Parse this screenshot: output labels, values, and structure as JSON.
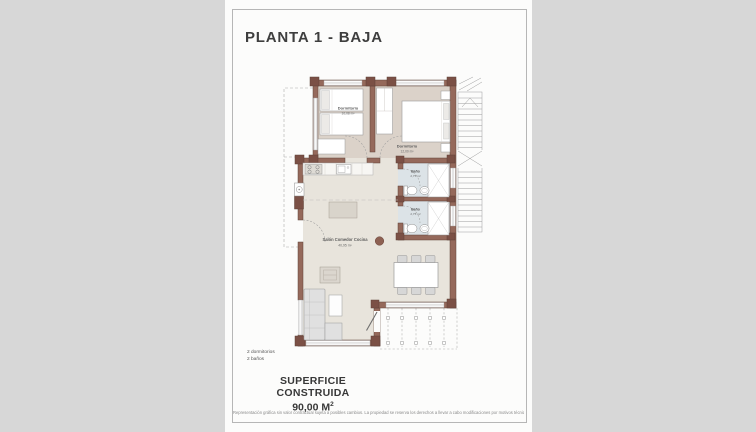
{
  "page": {
    "title": "PLANTA 1 - BAJA",
    "summary": {
      "line1": "2 dormitorios",
      "line2": "2 baños"
    },
    "superficie": {
      "label": "SUPERFICIE CONSTRUIDA",
      "value": "90,00 M",
      "sup": "2"
    },
    "disclaimer": "Representación gráfica sin valor contractual sujeta a posibles cambios. La propiedad se reserva los derechos a llevar a cabo modificaciones por motivos técnicos y cumpliendo la normativa vigente."
  },
  "plan": {
    "rooms": {
      "dormitorio1": {
        "name": "Dormitorio",
        "area": "10,08 m²"
      },
      "dormitorio2": {
        "name": "Dormitorio",
        "area": "12,00 m²"
      },
      "bano1": {
        "name": "Baño",
        "area": "2,75 m²"
      },
      "bano2": {
        "name": "Baño",
        "area": "2,75 m²"
      },
      "salon": {
        "name": "Salón Comedor Cocina",
        "area": "40,95 m²"
      }
    },
    "colors": {
      "wall": "#95695b",
      "wall_dark": "#7b5045",
      "floor_bedroom": "#dbd2c9",
      "floor_salon": "#e8e4dc",
      "floor_bath": "#dce3e7",
      "accent_column": "#8d6052"
    }
  }
}
